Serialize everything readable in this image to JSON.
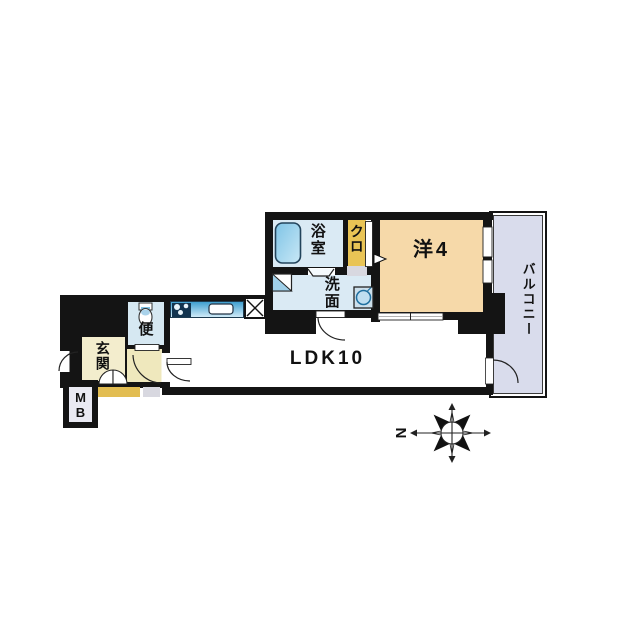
{
  "plan": {
    "rooms": {
      "bath": {
        "label": "浴室"
      },
      "closet": {
        "label": "クロ"
      },
      "western_room": {
        "label": "洋4"
      },
      "washroom": {
        "label": "洗面"
      },
      "toilet": {
        "label": "便"
      },
      "entrance": {
        "label": "玄関"
      },
      "ldk": {
        "label": "LDK10"
      },
      "balcony": {
        "label": "バルコニー"
      }
    },
    "meter_box": {
      "line1": "M",
      "line2": "B"
    },
    "compass": {
      "north_label": "N",
      "north_direction": "left"
    },
    "icons": {
      "bathtub": "bathtub-icon",
      "wash_basin": "wash-basin-icon",
      "washing_machine": "washing-machine-icon",
      "toilet_bowl": "toilet-icon",
      "stove": "stove-icon",
      "kitchen_sink": "kitchen-sink-icon",
      "refrigerator_space": "crossed-box-icon",
      "compass": "compass-rose-icon"
    },
    "colors": {
      "wall": "#141414",
      "wet_rooms": "#daeaf4",
      "toilet_room": "#d6e8f2",
      "closet": "#e9c455",
      "western_room": "#f6d9a9",
      "entrance": "#f3edcd",
      "hallway": "#efe8bd",
      "porch_gold": "#e2bd52",
      "porch_gray": "#d8d8e0",
      "balcony": "#d9dcec",
      "counter_blue": "#3f9fd0"
    }
  }
}
